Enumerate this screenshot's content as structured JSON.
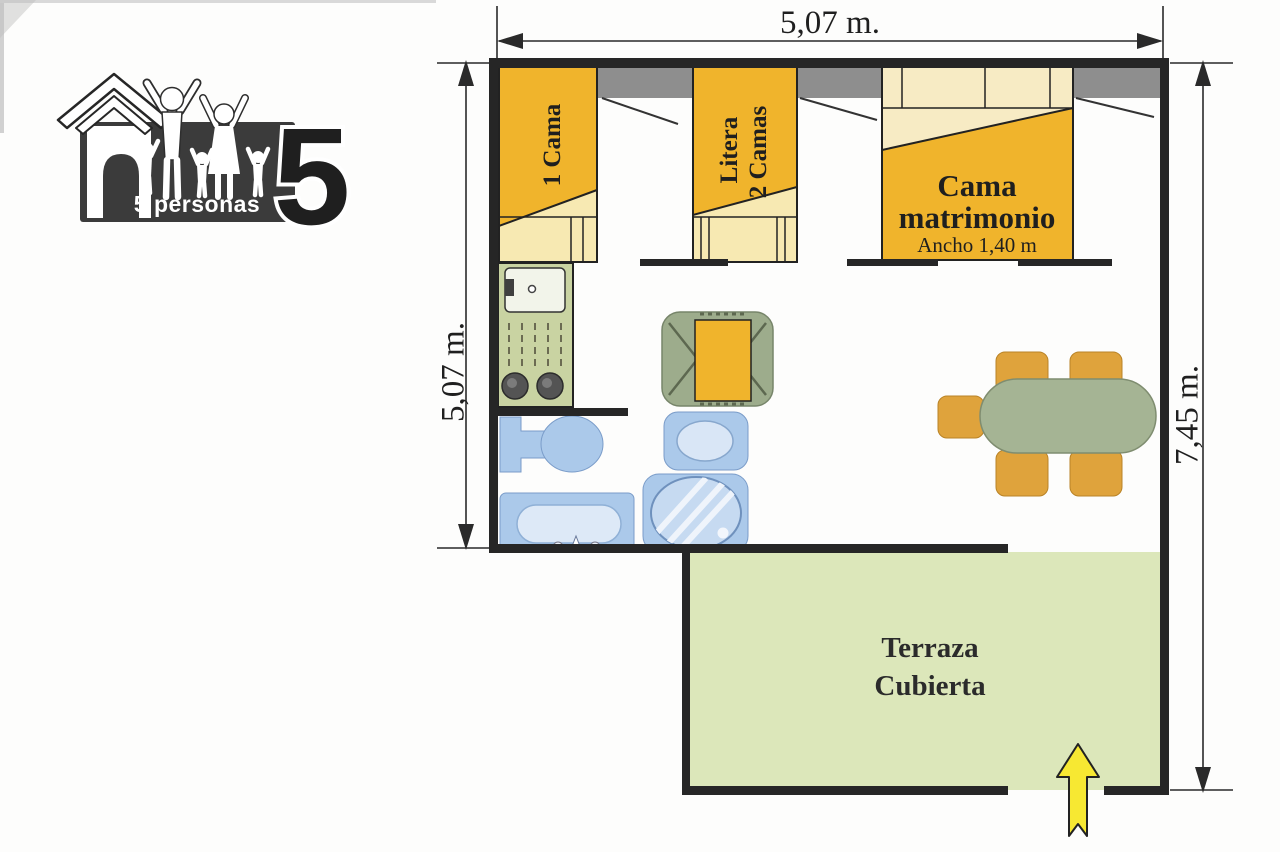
{
  "badge": {
    "caption": "5 personas",
    "number": "5"
  },
  "dimensions": {
    "top": "5,07 m.",
    "left": "5,07 m.",
    "right": "7,45 m."
  },
  "beds": {
    "single_label": "1 Cama",
    "bunk_label_line1": "Litera",
    "bunk_label_line2": "2 Camas",
    "double_label_line1": "Cama",
    "double_label_line2": "matrimonio",
    "double_width_note": "Ancho 1,40 m"
  },
  "terrace": {
    "label_line1": "Terraza",
    "label_line2": "Cubierta"
  },
  "colors": {
    "wall": "#262626",
    "bed_orange": "#F0B42C",
    "bed_linen": "#F7E9B2",
    "double_bed_linen": "#F7EBC4",
    "window_gray": "#8E8E8E",
    "kitchen_counter": "#C9D3A2",
    "bathroom_blue": "#ABC9EA",
    "furniture_green": "#9DAC8C",
    "table_green": "#A5B494",
    "chair_amber": "#DFA33C",
    "terrace_green": "#DCE7BA",
    "arrow_yellow": "#F7E832",
    "badge_dark": "#3B3B3B"
  }
}
